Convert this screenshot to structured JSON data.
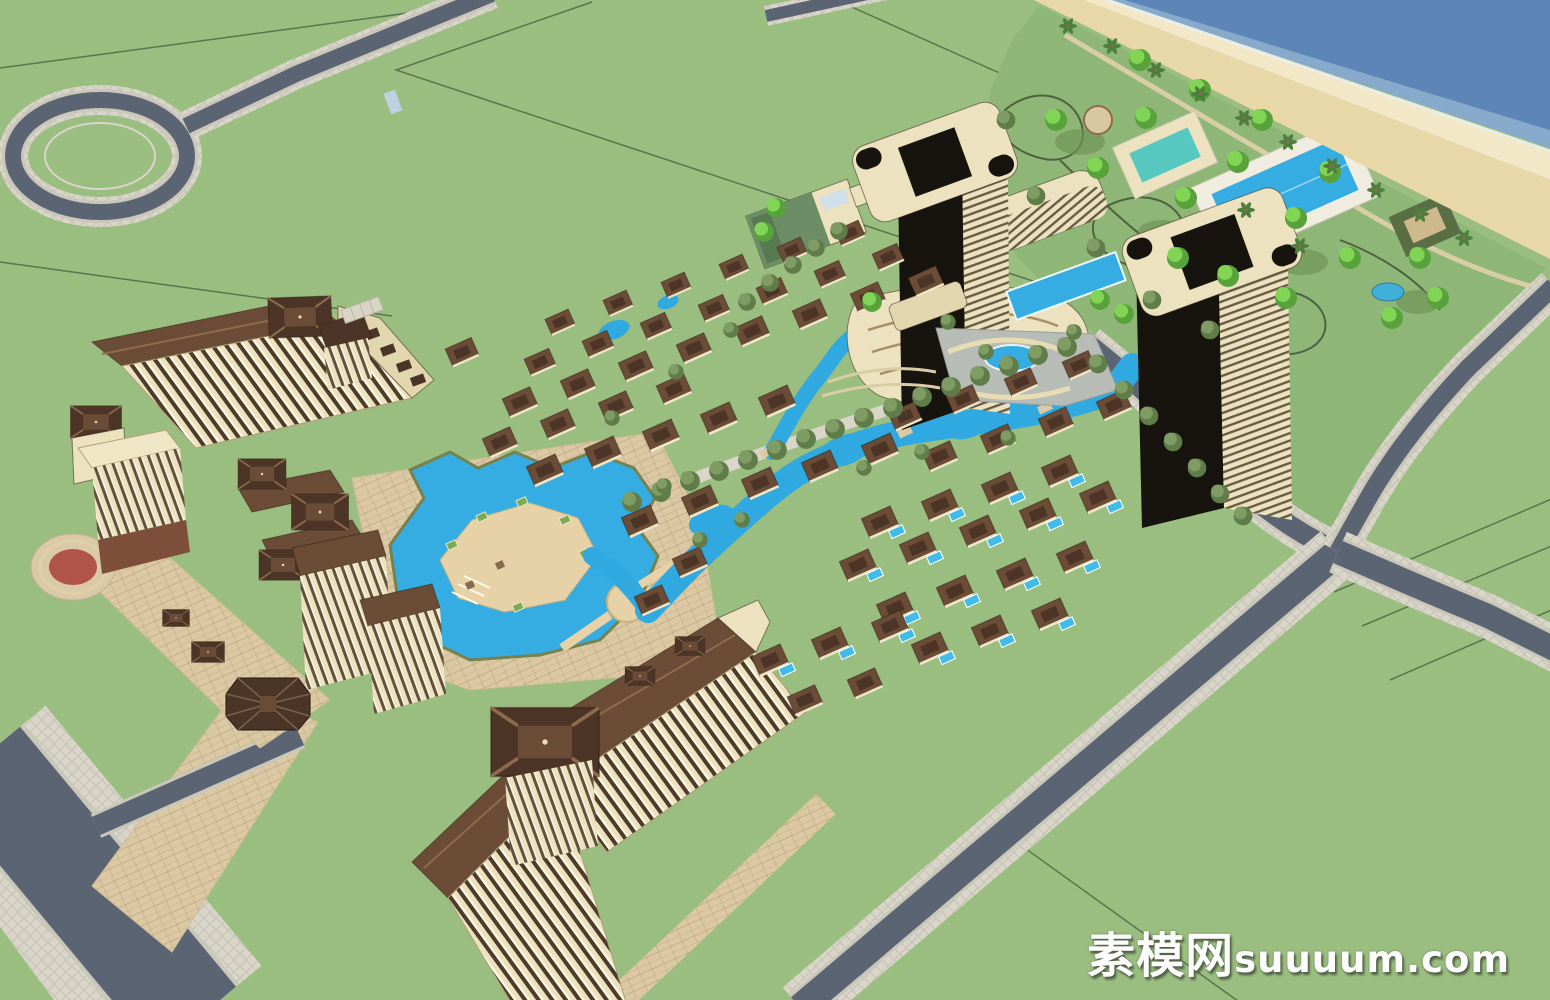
{
  "watermark": {
    "cjk": "素模网",
    "latin": "suuuum.com"
  },
  "palette": {
    "grass": "#9abd80",
    "garden": "#8eb677",
    "parcel": "#4c6a43",
    "ocean": "#5e85b7",
    "shallow": "#87a9cc",
    "surf": "#edf1ef",
    "sand": "#e8d7a7",
    "sandWet": "#f2e7c6",
    "road": "#5b6472",
    "curb": "#c9c6ba",
    "sidewalk": "#d9d5c9",
    "plaza": "#dcc9a4",
    "plazaGray": "#b7bcb7",
    "deck": "#e6d2a6",
    "deckEdge": "#cdb27e",
    "pool": "#35ade2",
    "lagoon": "#2fa9e0",
    "poolPrivate": "#41bce8",
    "cream": "#ece2bf",
    "creamShade": "#e2d6ae",
    "roofDark": "#4c3527",
    "roofMid": "#6b4c36",
    "roofRidge": "#8d6b4c",
    "glass": "#17130e",
    "greenRoof": "#6d8d66",
    "treeOlive": "#7e9c63",
    "treeOliveDark": "#5f7c49",
    "treeBright": "#82d455",
    "treeBrightDark": "#58a23b",
    "palm": "#4f7f3e",
    "gardenPath": "#3d4d31",
    "fountain": "#b05348",
    "brick": "#7d4f3a",
    "white": "#ffffff"
  }
}
